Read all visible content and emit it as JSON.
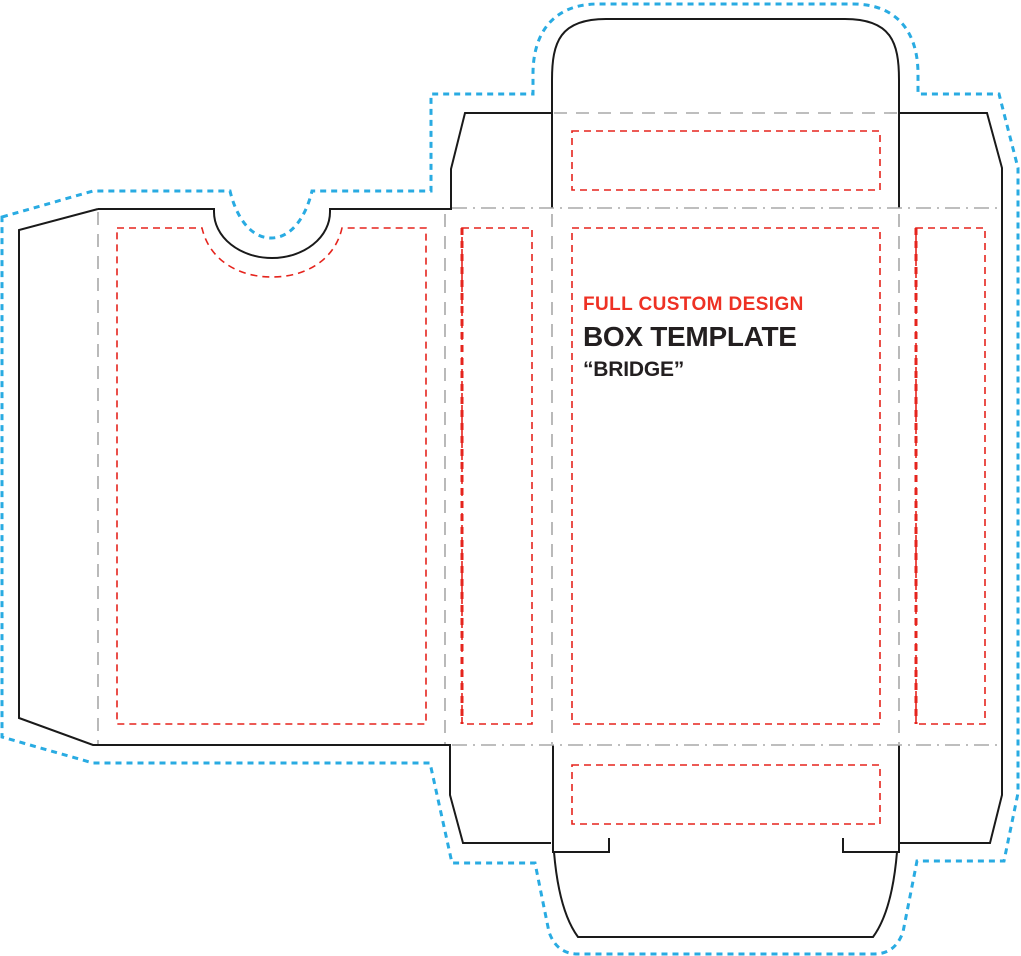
{
  "title": {
    "line1": "FULL CUSTOM DESIGN",
    "line2": "BOX TEMPLATE",
    "line3": "“BRIDGE”"
  },
  "colors": {
    "cut": "#1a1a1a",
    "fold": "#a8a8a8",
    "safe": "#e5241d",
    "bleed": "#29abe2",
    "accent_text": "#ee3124",
    "heading_text": "#231f20",
    "background": "#ffffff"
  }
}
